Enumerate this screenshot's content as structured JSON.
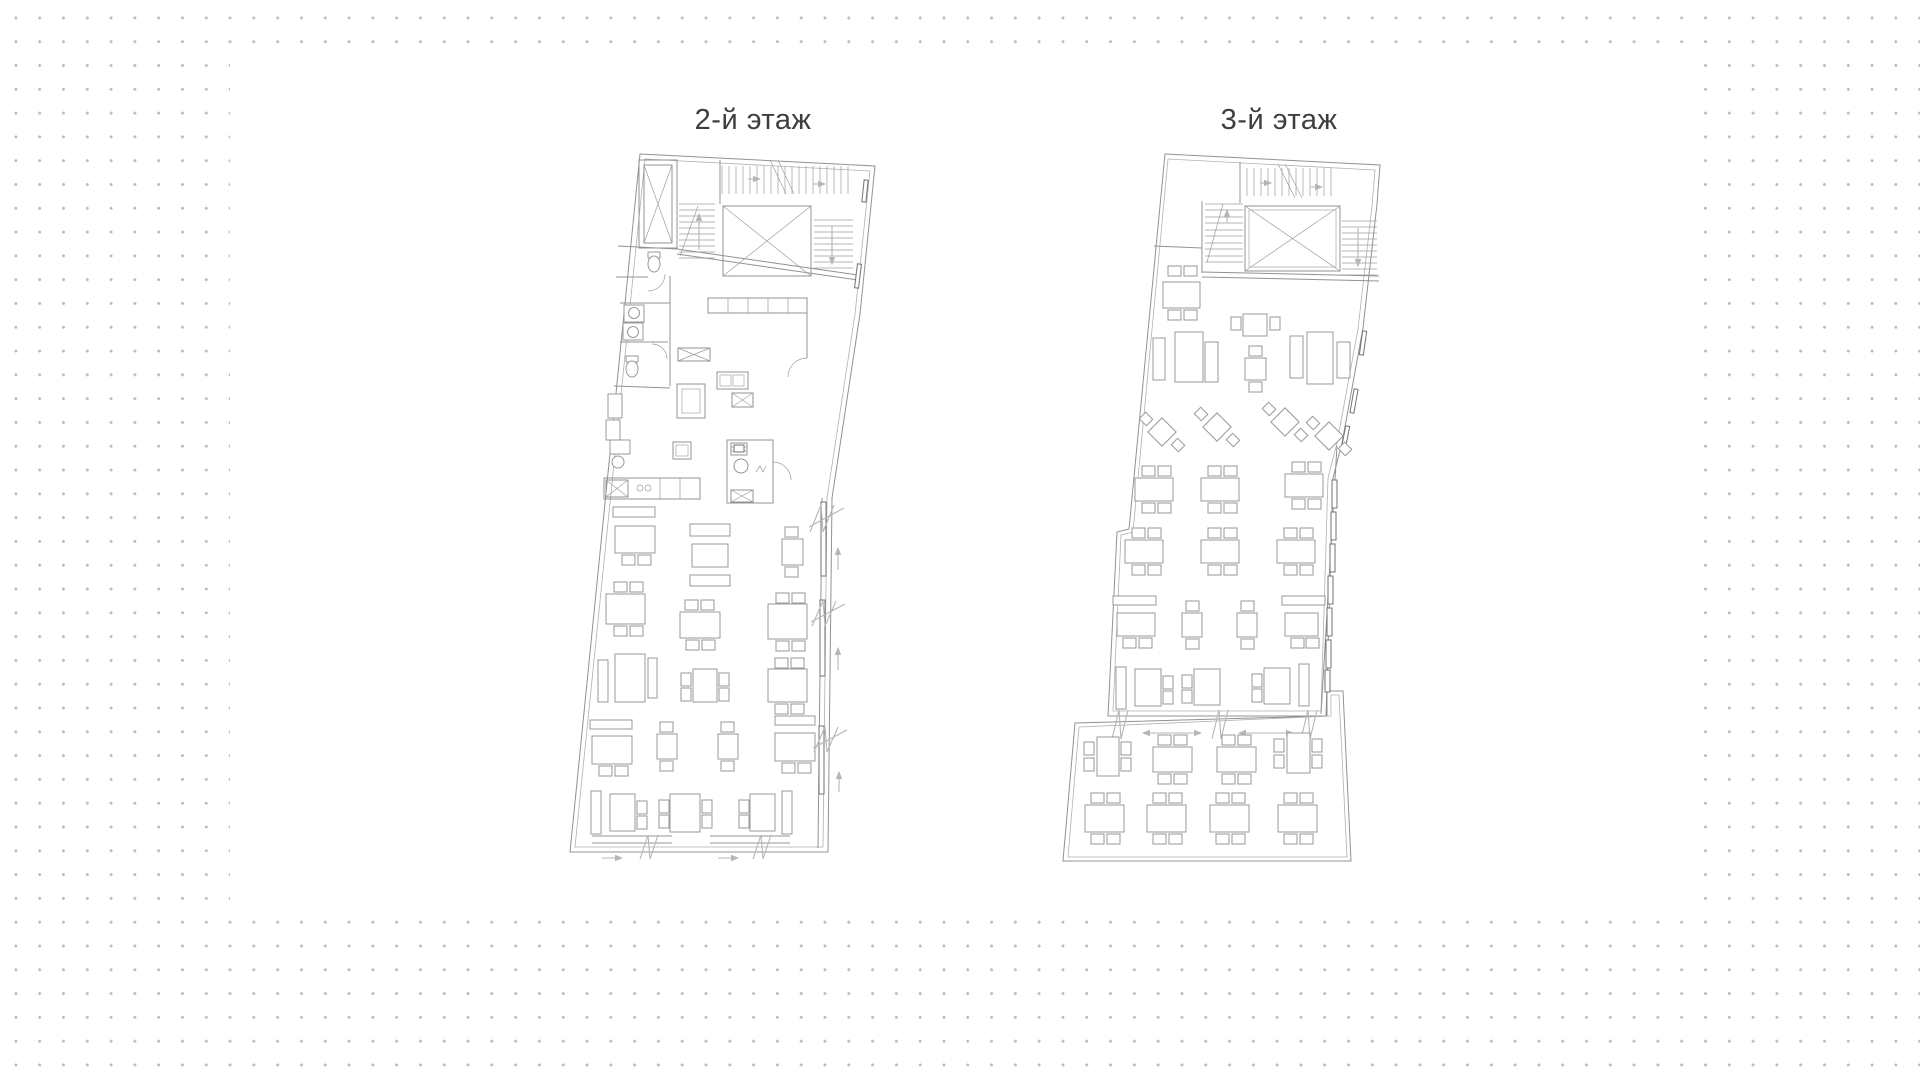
{
  "page": {
    "dot_color": "#b9bbbe",
    "panel_color": "#ffffff",
    "drawing_line_color": "#8f9396",
    "title_color": "#3e3e3e"
  },
  "plans": [
    {
      "id": "floor-2",
      "title": "2-й этаж"
    },
    {
      "id": "floor-3",
      "title": "3-й этаж"
    }
  ]
}
